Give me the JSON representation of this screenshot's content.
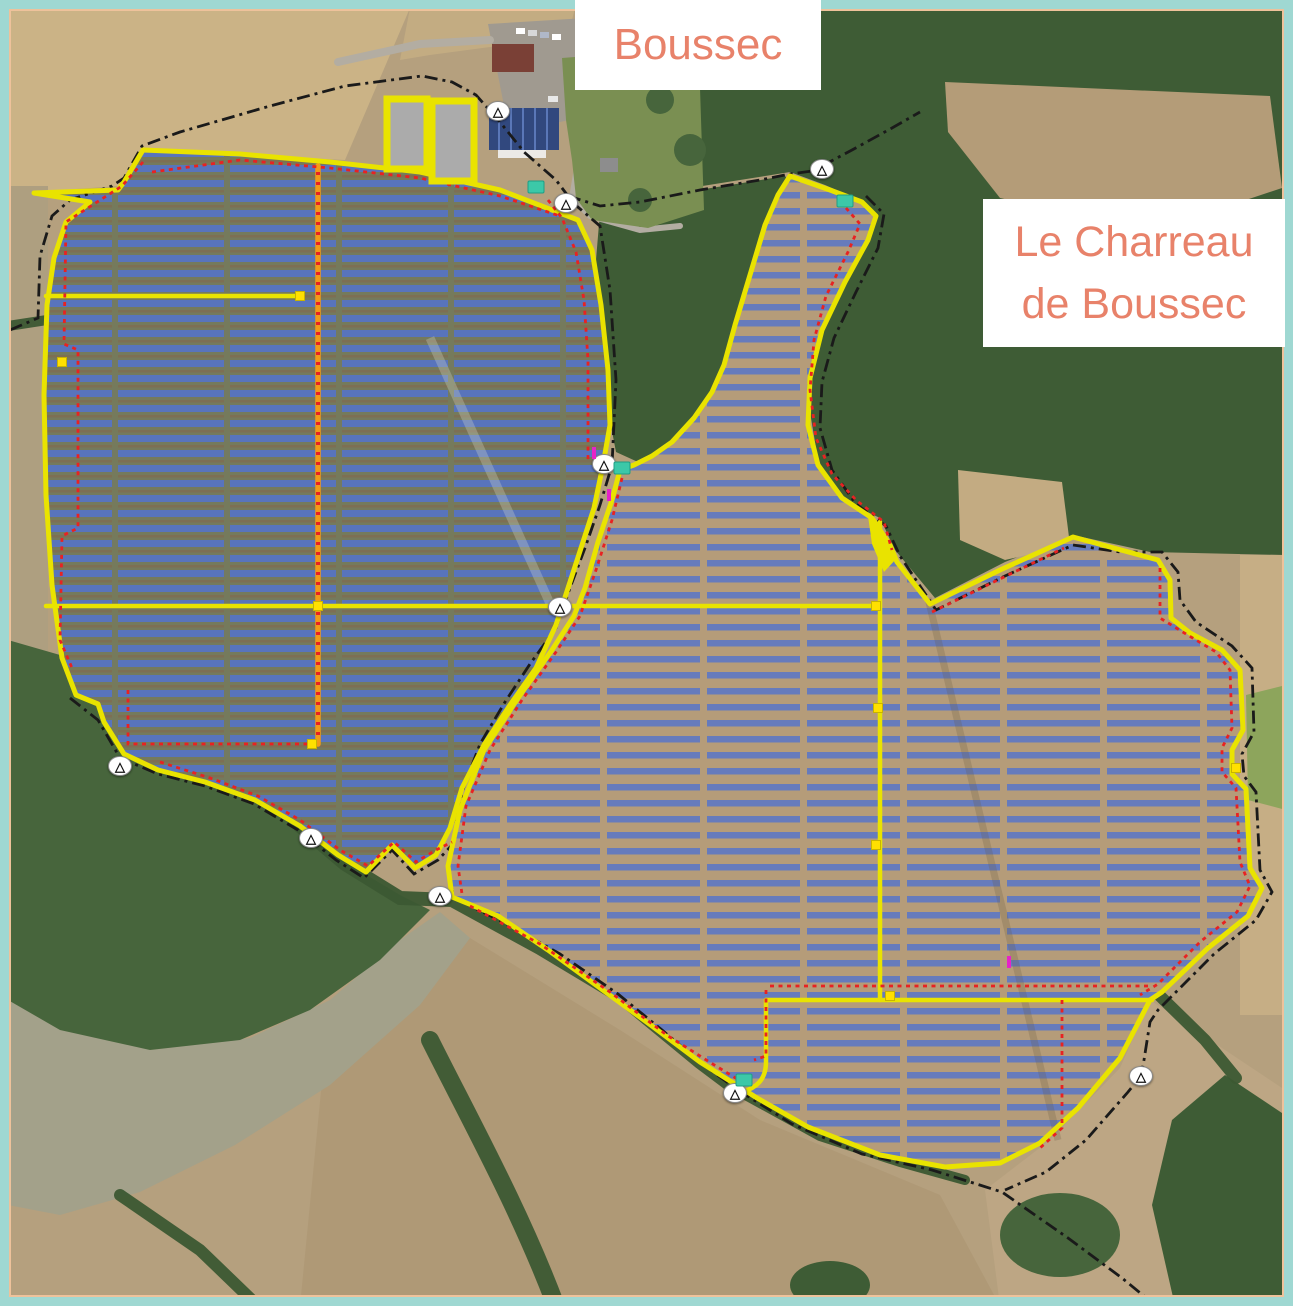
{
  "map": {
    "place_labels": [
      {
        "id": "boussec",
        "text": "Boussec"
      },
      {
        "id": "le-charreau-de-boussec",
        "line1": "Le Charreau",
        "line2": "de Boussec"
      }
    ]
  },
  "colors": {
    "frame_outer": "#9fd8d2",
    "frame_inner": "#eec29b",
    "label_bg": "#ffffff",
    "label_text": "#e8826a",
    "panel_row_blue": "#5373cd",
    "site_boundary_yellow": "#e9e300",
    "internal_road_orange": "#f29a18",
    "fence_red": "#e82222",
    "cadastral_black": "#1a1a1a",
    "transformer_teal": "#3cc8a8",
    "storage_gray": "#ababab",
    "node_yellow": "#ffe000",
    "gate_white": "#ffffff",
    "tick_magenta": "#e623c8"
  },
  "legend": {
    "features": [
      {
        "name": "solar-panel-rows",
        "color_key": "panel_row_blue"
      },
      {
        "name": "site-perimeter-road",
        "color_key": "site_boundary_yellow"
      },
      {
        "name": "internal-access-road",
        "color_key": "internal_road_orange"
      },
      {
        "name": "security-fence",
        "color_key": "fence_red"
      },
      {
        "name": "property-boundary",
        "color_key": "cadastral_black"
      },
      {
        "name": "technical-station",
        "color_key": "transformer_teal"
      },
      {
        "name": "laydown-area",
        "color_key": "storage_gray"
      },
      {
        "name": "access-gate",
        "color_key": "gate_white"
      }
    ]
  },
  "markers": {
    "gate_glyph": "△",
    "gates": [
      {
        "x": 566,
        "y": 203
      },
      {
        "x": 498,
        "y": 111
      },
      {
        "x": 822,
        "y": 169
      },
      {
        "x": 604,
        "y": 464
      },
      {
        "x": 560,
        "y": 607
      },
      {
        "x": 120,
        "y": 766
      },
      {
        "x": 311,
        "y": 838
      },
      {
        "x": 440,
        "y": 896
      },
      {
        "x": 735,
        "y": 1093
      },
      {
        "x": 1141,
        "y": 1076
      }
    ],
    "transformers": [
      {
        "x": 536,
        "y": 187
      },
      {
        "x": 845,
        "y": 201
      },
      {
        "x": 622,
        "y": 468
      },
      {
        "x": 744,
        "y": 1080
      }
    ],
    "road_nodes": [
      {
        "x": 300,
        "y": 296
      },
      {
        "x": 318,
        "y": 606
      },
      {
        "x": 312,
        "y": 744
      },
      {
        "x": 62,
        "y": 362
      },
      {
        "x": 876,
        "y": 606
      },
      {
        "x": 878,
        "y": 708
      },
      {
        "x": 876,
        "y": 845
      },
      {
        "x": 890,
        "y": 996
      },
      {
        "x": 1236,
        "y": 768
      }
    ],
    "survey_ticks": [
      {
        "x": 594,
        "y": 453
      },
      {
        "x": 609,
        "y": 495
      },
      {
        "x": 1009,
        "y": 962
      }
    ]
  }
}
